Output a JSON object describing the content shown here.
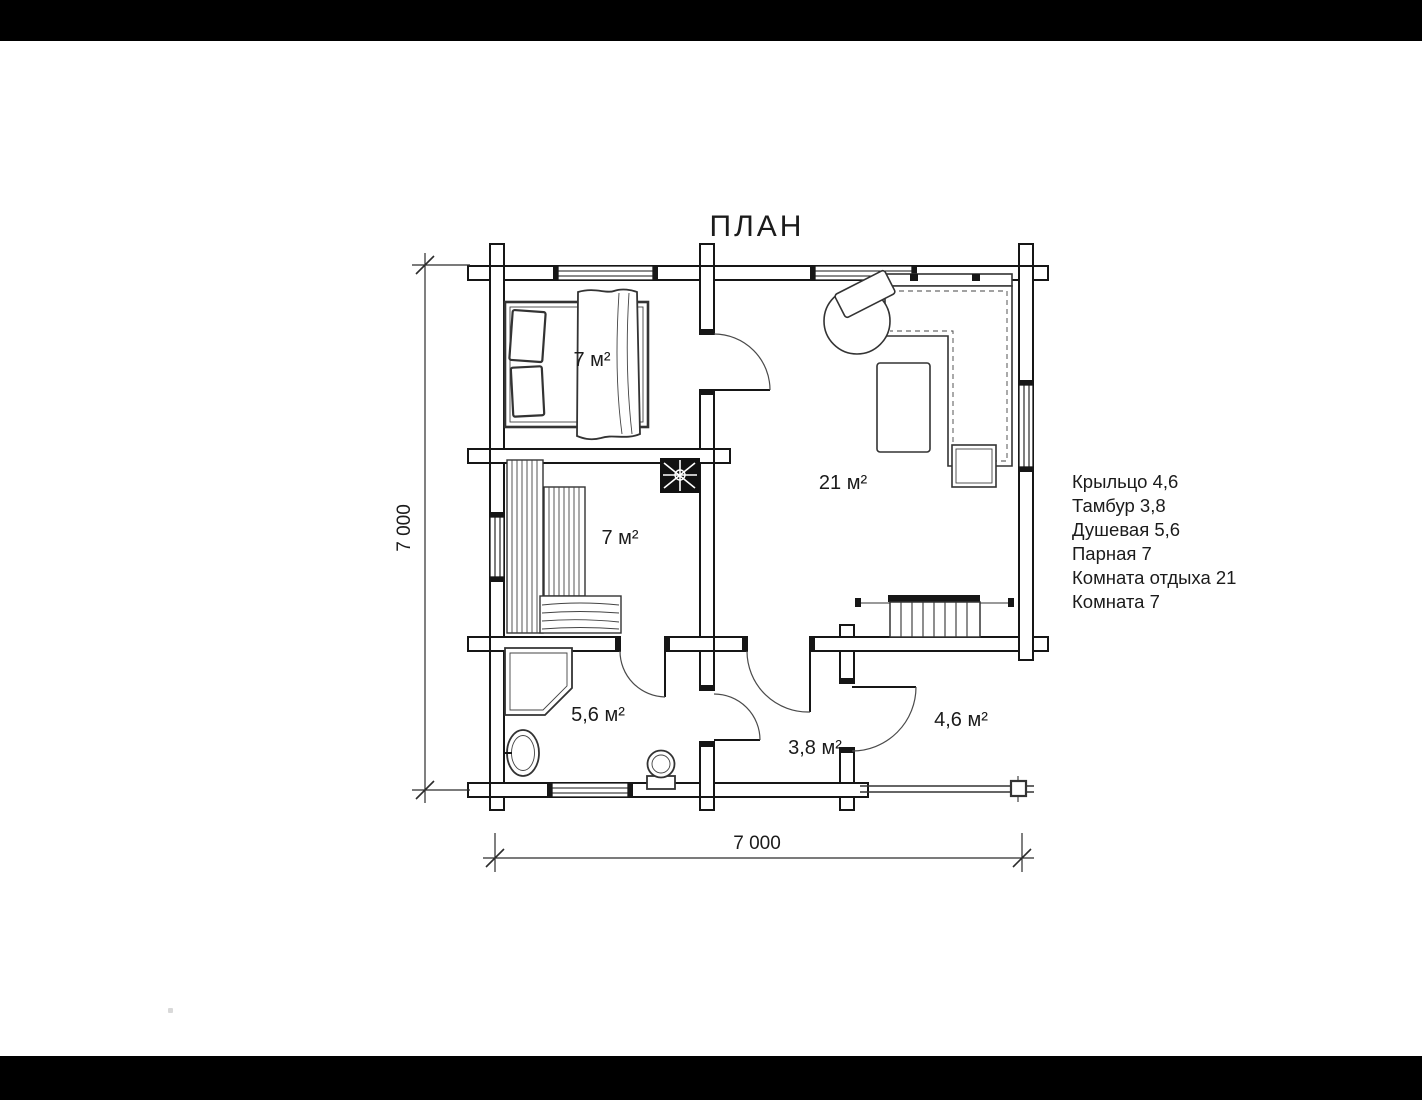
{
  "title": "ПЛАН",
  "dimensions": {
    "vertical": "7 000",
    "horizontal": "7 000"
  },
  "rooms": {
    "bedroom": {
      "label": "7 м²"
    },
    "steam": {
      "label": "7 м²"
    },
    "lounge": {
      "label": "21 м²"
    },
    "shower": {
      "label": "5,6 м²"
    },
    "tambour": {
      "label": "3,8 м²"
    },
    "porch": {
      "label": "4,6 м²"
    }
  },
  "legend": {
    "items": [
      "Крыльцо 4,6",
      "Тамбур 3,8",
      "Душевая 5,6",
      "Парная 7",
      "Комната отдыха 21",
      "Комната 7"
    ]
  },
  "colors": {
    "ink": "#1b1b1b",
    "paper": "#ffffff",
    "letterbox": "#000000"
  }
}
